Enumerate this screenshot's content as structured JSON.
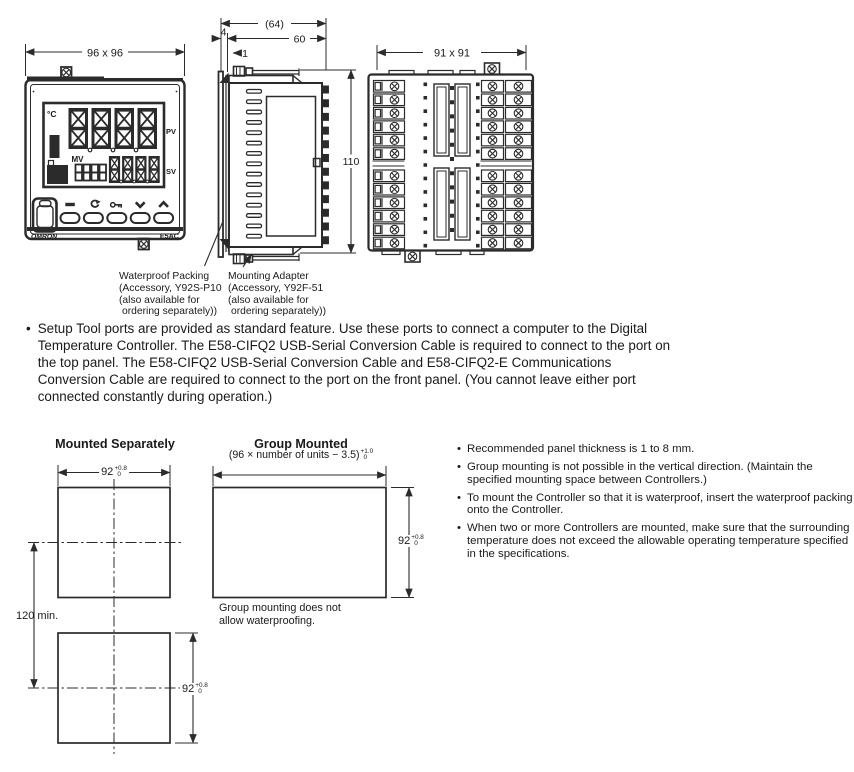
{
  "bullet": "•",
  "front_view": {
    "dim": "96 x 96",
    "display": {
      "unit": "°C",
      "pv_label": "PV",
      "sv_label": "SV",
      "mv_label": "MV"
    },
    "brand": "OMRON",
    "model": "E5AC"
  },
  "side_view": {
    "dim_overall": "(64)",
    "dim_depth": "60",
    "dim_flange": "4",
    "dim_packing": "1",
    "dim_height": "110"
  },
  "rear_view": {
    "dim": "91 x 91"
  },
  "callouts": {
    "waterproof": [
      "Waterproof Packing",
      "(Accessory, Y92S-P10",
      "(also available for",
      "ordering separately))"
    ],
    "adapter": [
      "Mounting Adapter",
      "(Accessory, Y92F-51",
      "(also available for",
      "ordering separately))"
    ]
  },
  "setup_note": "Setup Tool ports are provided as standard feature. Use these ports to connect a computer to the Digital Temperature Controller. The E58-CIFQ2 USB-Serial Conversion Cable is required to connect to the port on the top panel. The E58-CIFQ2 USB-Serial Conversion Cable and E58-CIFQ2-E Communications Conversion Cable are required to connect to the port on the front panel. (You cannot leave either port connected constantly during operation.)",
  "cutout": {
    "left_title": "Mounted Separately",
    "right_title": "Group Mounted",
    "formula_base": "(96 × number of units − 3.5)",
    "formula_tol": {
      "sup": "+1.0",
      "sub": "0"
    },
    "width_dim": {
      "value": "92",
      "sup": "+0.8",
      "sub": "0"
    },
    "spacing_dim": "120 min.",
    "group_note": [
      "Group mounting does not",
      "allow waterproofing."
    ]
  },
  "notes": [
    "Recommended panel thickness is 1 to 8 mm.",
    "Group mounting is not possible in the vertical direction. (Maintain the specified mounting space between Controllers.)",
    "To mount the Controller so that it is waterproof, insert the waterproof packing onto the Controller.",
    "When two or more Controllers are mounted, make sure that the surrounding temperature does not exceed the allowable operating temperature specified in the specifications."
  ],
  "icons": {
    "level_key": "bar",
    "mode_key": "circulating-arrow",
    "shift_key": "key",
    "down_key": "chevron-down",
    "up_key": "chevron-up",
    "screw": "circled-cross"
  },
  "colors": {
    "ink": "#1d1d1d",
    "line": "#2b2b2b",
    "background": "#ffffff"
  }
}
